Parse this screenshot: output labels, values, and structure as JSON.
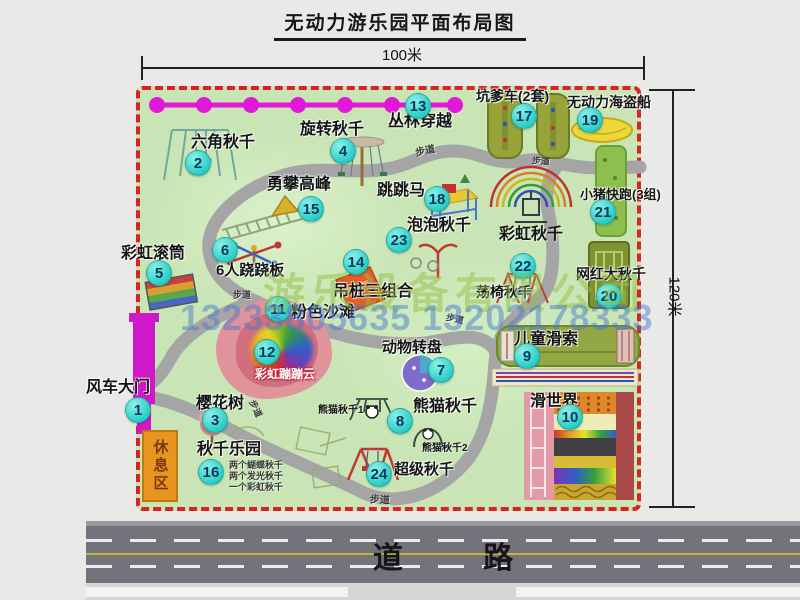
{
  "title": "无动力游乐园平面布局图",
  "dimensions": {
    "top": "100米",
    "right": "120米"
  },
  "road": {
    "label": "道  路"
  },
  "watermarks": {
    "company": "游乐设备有限公司",
    "phone": "13233805635 13202178333"
  },
  "park": {
    "rest_area": "休息区",
    "items": [
      {
        "n": "1",
        "t": "风车大门",
        "b": [
          138,
          410
        ],
        "l": [
          86,
          380
        ],
        "fs": 16
      },
      {
        "n": "2",
        "t": "六角秋千",
        "b": [
          198,
          163
        ],
        "l": [
          191,
          135
        ],
        "fs": 16
      },
      {
        "n": "3",
        "t": "樱花树",
        "b": [
          215,
          420
        ],
        "l": [
          196,
          396
        ],
        "fs": 16
      },
      {
        "n": "4",
        "t": "旋转秋千",
        "b": [
          343,
          151
        ],
        "l": [
          300,
          122
        ],
        "fs": 16
      },
      {
        "n": "5",
        "t": "彩虹滚筒",
        "b": [
          159,
          273
        ],
        "l": [
          121,
          246
        ],
        "fs": 16
      },
      {
        "n": "6",
        "t": "6人跷跷板",
        "b": [
          225,
          250
        ],
        "l": [
          216,
          263
        ],
        "fs": 15
      },
      {
        "n": "7",
        "t": "动物转盘",
        "b": [
          441,
          370
        ],
        "l": [
          382,
          340
        ],
        "fs": 15
      },
      {
        "n": "8",
        "t": "熊猫秋千",
        "b": [
          400,
          421
        ],
        "l": [
          413,
          399
        ],
        "fs": 16
      },
      {
        "n": "9",
        "t": "儿童滑索",
        "b": [
          527,
          356
        ],
        "l": [
          514,
          332
        ],
        "fs": 16
      },
      {
        "n": "10",
        "t": "滑世界",
        "b": [
          570,
          417
        ],
        "l": [
          530,
          394
        ],
        "fs": 16
      },
      {
        "n": "11",
        "t": "粉色沙滩",
        "b": [
          278,
          309
        ],
        "l": [
          291,
          305
        ],
        "fs": 16
      },
      {
        "n": "12",
        "t": "彩虹蹦蹦云",
        "b": [
          267,
          352
        ],
        "l": [
          255,
          368
        ],
        "fs": 12,
        "v": "cloud"
      },
      {
        "n": "13",
        "t": "丛林穿越",
        "b": [
          418,
          106
        ],
        "l": [
          388,
          114
        ],
        "fs": 16
      },
      {
        "n": "14",
        "t": "吊桩三组合",
        "b": [
          356,
          262
        ],
        "l": [
          333,
          284
        ],
        "fs": 16
      },
      {
        "n": "15",
        "t": "勇攀高峰",
        "b": [
          311,
          209
        ],
        "l": [
          267,
          177
        ],
        "fs": 16
      },
      {
        "n": "16",
        "t": "秋千乐园",
        "b": [
          211,
          472
        ],
        "l": [
          197,
          442
        ],
        "fs": 16
      },
      {
        "n": "17",
        "t": "坑爹车(2套)",
        "b": [
          524,
          116
        ],
        "l": [
          476,
          89
        ],
        "fs": 14
      },
      {
        "n": "18",
        "t": "跳跳马",
        "b": [
          437,
          199
        ],
        "l": [
          377,
          183
        ],
        "fs": 16
      },
      {
        "n": "19",
        "t": "无动力海盗船",
        "b": [
          590,
          120
        ],
        "l": [
          567,
          95
        ],
        "fs": 14
      },
      {
        "n": "20",
        "t": "网红大秋千",
        "b": [
          609,
          296
        ],
        "l": [
          576,
          267
        ],
        "fs": 14
      },
      {
        "n": "21",
        "t": "小猪快跑(3组)",
        "b": [
          603,
          212
        ],
        "l": [
          580,
          188
        ],
        "fs": 13
      },
      {
        "n": "22",
        "t": "荡椅秋千",
        "b": [
          523,
          266
        ],
        "l": [
          476,
          285
        ],
        "fs": 14
      },
      {
        "n": "23",
        "t": "泡泡秋千",
        "b": [
          399,
          240
        ],
        "l": [
          407,
          218
        ],
        "fs": 16
      },
      {
        "n": "24",
        "t": "超级秋千",
        "b": [
          379,
          474
        ],
        "l": [
          394,
          462
        ],
        "fs": 15
      }
    ],
    "texts": [
      {
        "n": "rainbow-swing-label",
        "t": "彩虹秋千",
        "x": 499,
        "y": 220,
        "fs": 16,
        "dark": true
      },
      {
        "n": "panda-swing-1-label",
        "t": "熊猫秋千1",
        "x": 318,
        "y": 401,
        "fs": 10,
        "dark": true
      },
      {
        "n": "panda-swing-2-label",
        "t": "熊猫秋千2",
        "x": 422,
        "y": 439,
        "fs": 10,
        "dark": true
      },
      {
        "n": "swing-park-note-1",
        "t": "两个蝴蝶秋千",
        "x": 229,
        "y": 458,
        "fs": 9
      },
      {
        "n": "swing-park-note-2",
        "t": "两个发光秋千",
        "x": 229,
        "y": 469,
        "fs": 9
      },
      {
        "n": "swing-park-note-3",
        "t": "一个彩虹秋千",
        "x": 229,
        "y": 480,
        "fs": 9
      },
      {
        "n": "path-label",
        "t": "步道",
        "x": 415,
        "y": 142,
        "fs": 10,
        "rot": -12
      },
      {
        "n": "path-label",
        "t": "步道",
        "x": 532,
        "y": 154,
        "fs": 9,
        "rot": 5
      },
      {
        "n": "path-label",
        "t": "步道",
        "x": 233,
        "y": 288,
        "fs": 9
      },
      {
        "n": "path-label",
        "t": "步道",
        "x": 370,
        "y": 491,
        "fs": 10,
        "rot": 3
      },
      {
        "n": "path-label",
        "t": "步道",
        "x": 446,
        "y": 312,
        "fs": 9,
        "rot": 12
      },
      {
        "n": "path-label",
        "t": "步道",
        "x": 247,
        "y": 402,
        "fs": 9,
        "rot": 65
      }
    ]
  }
}
